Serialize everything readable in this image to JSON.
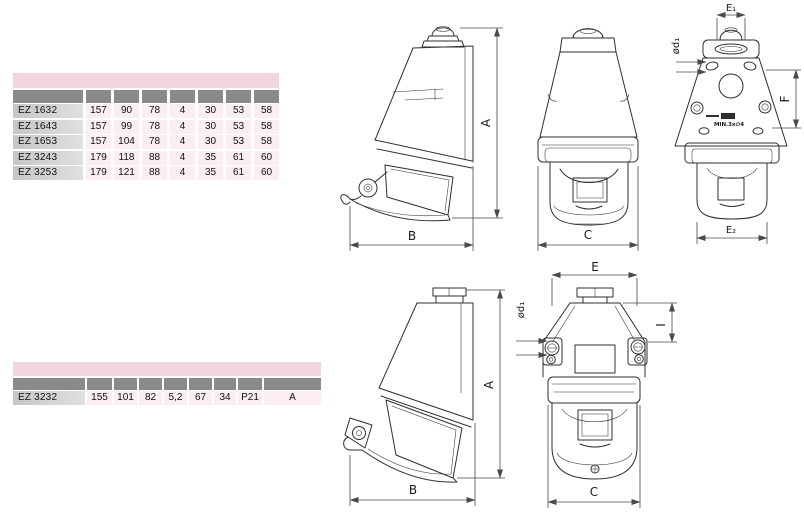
{
  "colors": {
    "table_pink_header": "#f2d5e0",
    "table_gray_header": "#8a8a8a",
    "table_name_cell": "#d3d3d3",
    "table_value_cell": "#faeef3",
    "drawing_line": "#2f2f2f"
  },
  "table1": {
    "rows": [
      {
        "name": "EZ 1632",
        "values": [
          "157",
          "90",
          "78",
          "4",
          "30",
          "53",
          "58"
        ]
      },
      {
        "name": "EZ 1643",
        "values": [
          "157",
          "99",
          "78",
          "4",
          "30",
          "53",
          "58"
        ]
      },
      {
        "name": "EZ 1653",
        "values": [
          "157",
          "104",
          "78",
          "4",
          "30",
          "53",
          "58"
        ]
      },
      {
        "name": "EZ 3243",
        "values": [
          "179",
          "118",
          "88",
          "4",
          "35",
          "61",
          "60"
        ]
      },
      {
        "name": "EZ 3253",
        "values": [
          "179",
          "121",
          "88",
          "4",
          "35",
          "61",
          "60"
        ]
      }
    ]
  },
  "table2": {
    "rows": [
      {
        "name": "EZ 3232",
        "values": [
          "155",
          "101",
          "82",
          "5,2",
          "67",
          "34",
          "P21",
          "A"
        ]
      }
    ]
  },
  "drawings": {
    "top_side": {
      "dim_vertical": "A",
      "dim_horizontal": "B"
    },
    "top_front": {
      "dim_width": "C"
    },
    "top_back": {
      "dim_top": "E₁",
      "dim_hole": "ød₁",
      "dim_right": "F",
      "dim_bottom": "E₂",
      "note": "MIN.3x∅4"
    },
    "bottom_side": {
      "dim_vertical": "A",
      "dim_horizontal": "B"
    },
    "bottom_front": {
      "dim_top": "E",
      "dim_hole": "ød₁",
      "dim_right": "I",
      "dim_bottom": "C"
    }
  }
}
